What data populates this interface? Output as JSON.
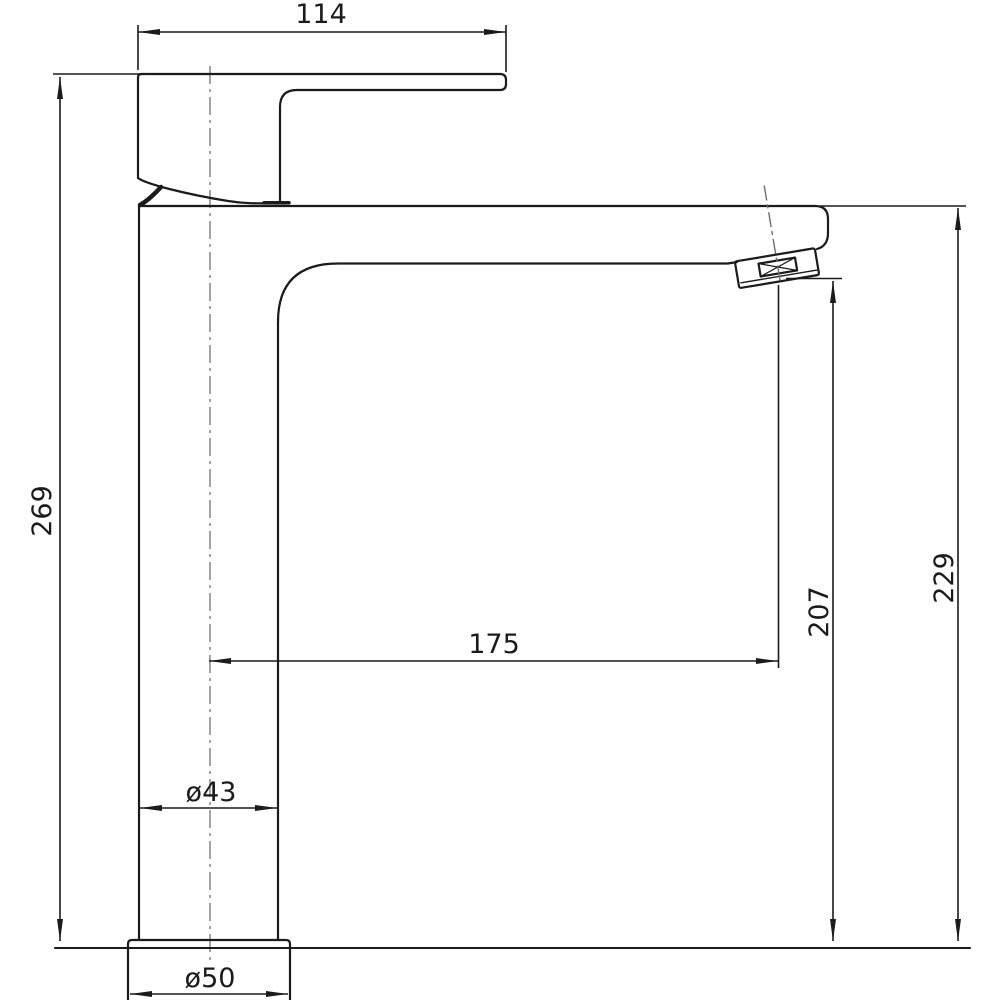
{
  "drawing": {
    "subject": "tall-single-lever-basin-mixer-side-elevation",
    "background_color": "#ffffff",
    "line_color": "#1b1b1b",
    "centerline_color": "#7d7d7d",
    "dimensions": {
      "handle_length": "114",
      "overall_height": "269",
      "spout_reach": "175",
      "outlet_height": "207",
      "spout_top_height": "229",
      "body_diameter": "ø43",
      "base_diameter": "ø50"
    }
  }
}
